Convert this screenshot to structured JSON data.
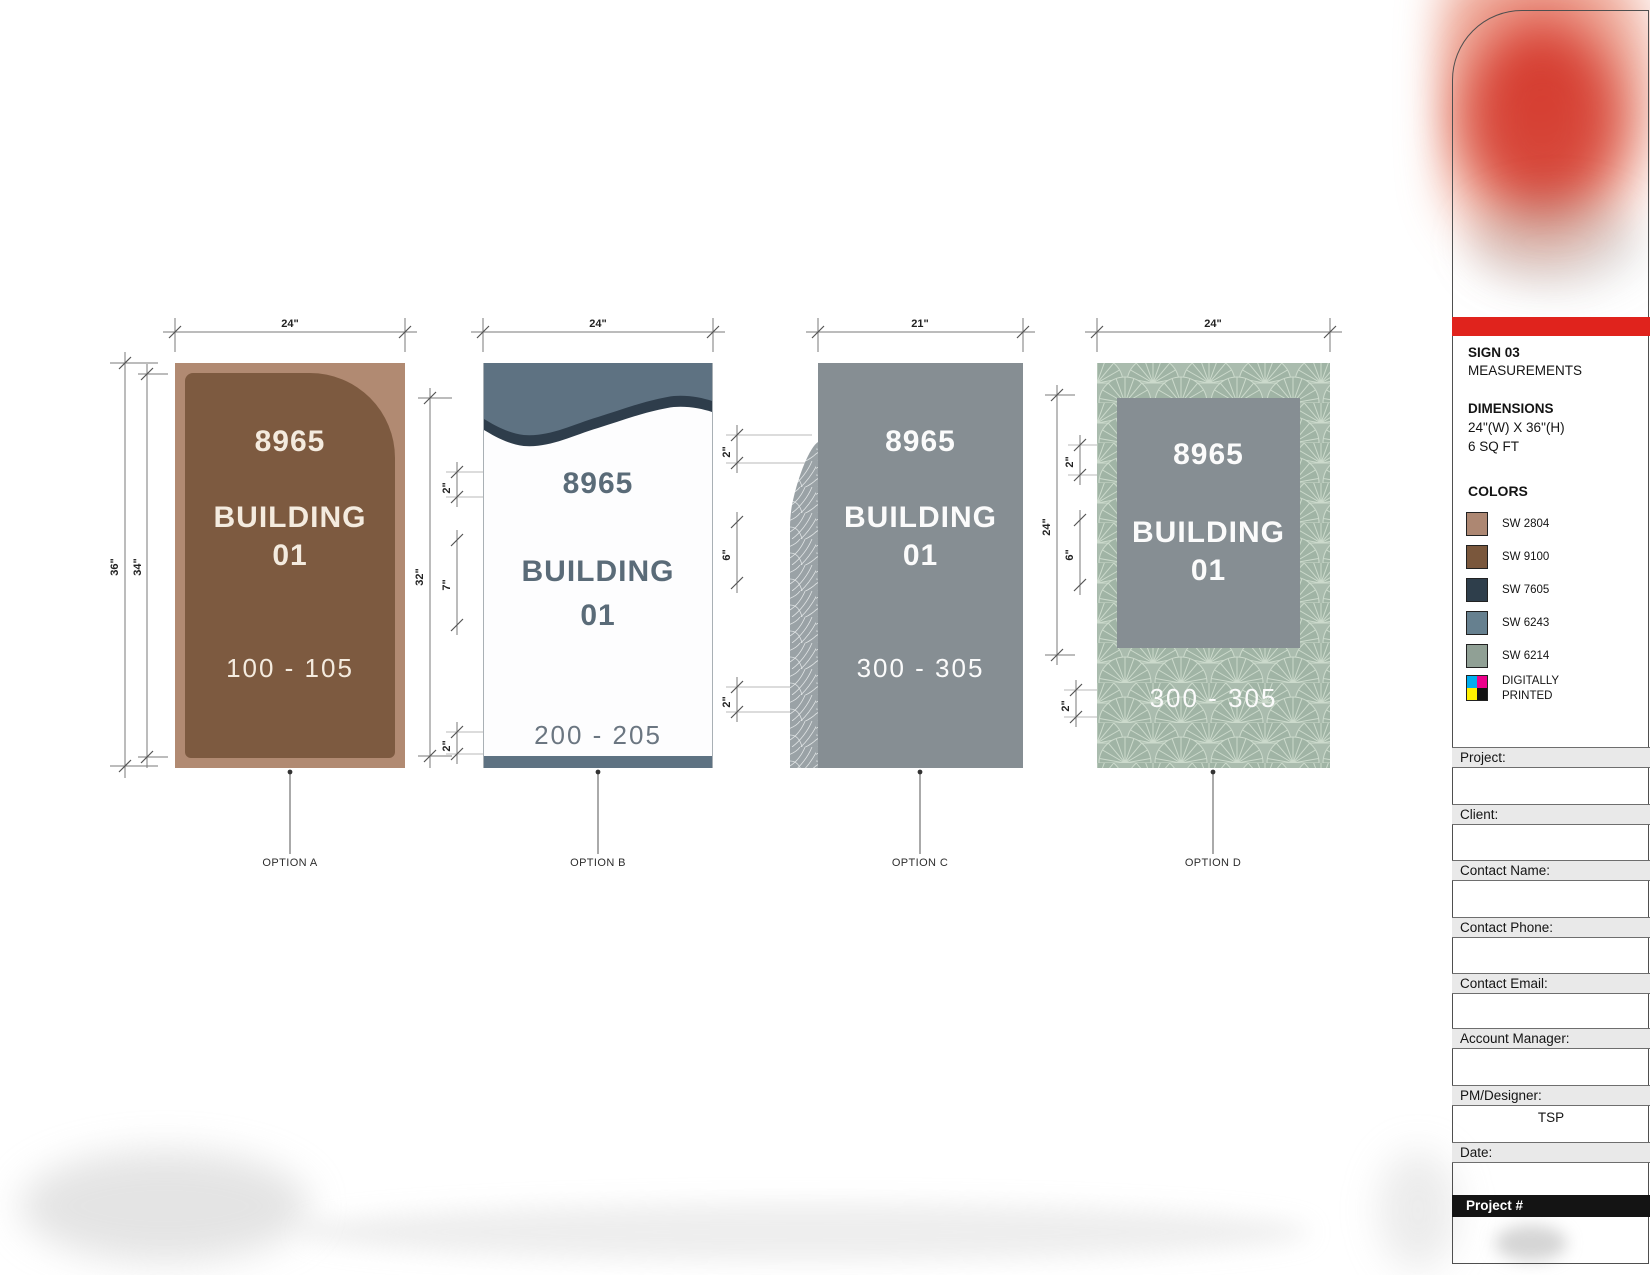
{
  "signs": {
    "a": {
      "option_label": "OPTION A",
      "address": "8965",
      "building": "BUILDING",
      "number": "01",
      "range": "100 - 105"
    },
    "b": {
      "option_label": "OPTION B",
      "address": "8965",
      "building": "BUILDING",
      "number": "01",
      "range": "200 - 205"
    },
    "c": {
      "option_label": "OPTION C",
      "address": "8965",
      "building": "BUILDING",
      "number": "01",
      "range": "300 - 305"
    },
    "d": {
      "option_label": "OPTION D",
      "address": "8965",
      "building": "BUILDING",
      "number": "01",
      "range": "300 - 305"
    }
  },
  "dims": {
    "a": {
      "w": "24\"",
      "outer_h": "36\"",
      "inner_h": "34\""
    },
    "b": {
      "w": "24\"",
      "h": "32\"",
      "top": "2\"",
      "mid": "7\"",
      "bot": "2\""
    },
    "c": {
      "w": "21\"",
      "top": "2\"",
      "mid": "6\"",
      "bot": "2\""
    },
    "d": {
      "w": "24\"",
      "panel_h": "24\"",
      "top": "2\"",
      "mid": "6\"",
      "bot": "2\""
    }
  },
  "sidebar": {
    "sign_title": "SIGN 03",
    "sign_subtitle": "MEASUREMENTS",
    "dimensions_heading": "DIMENSIONS",
    "dimensions_value": "24\"(W) X 36\"(H)",
    "dimensions_area": "6 SQ FT",
    "colors_heading": "COLORS",
    "accent_red": "#e0231d",
    "swatches": [
      {
        "code": "SW 2804",
        "hex": "#ad8772"
      },
      {
        "code": "SW 9100",
        "hex": "#7a573c"
      },
      {
        "code": "SW 7605",
        "hex": "#2e3e4b"
      },
      {
        "code": "SW 6243",
        "hex": "#66808f"
      },
      {
        "code": "SW 6214",
        "hex": "#90a095"
      }
    ],
    "cmyk": [
      "#00adee",
      "#ec008b",
      "#fff100",
      "#121212"
    ],
    "print_note_line1": "DIGITALLY",
    "print_note_line2": "PRINTED",
    "fields": [
      {
        "label": "Project:",
        "value": ""
      },
      {
        "label": "Client:",
        "value": ""
      },
      {
        "label": "Contact Name:",
        "value": ""
      },
      {
        "label": "Contact Phone:",
        "value": ""
      },
      {
        "label": "Contact Email:",
        "value": ""
      },
      {
        "label": "Account Manager:",
        "value": ""
      },
      {
        "label": "PM/Designer:",
        "value": "TSP"
      },
      {
        "label": "Date:",
        "value": ""
      }
    ],
    "project_number_label": "Project #"
  }
}
